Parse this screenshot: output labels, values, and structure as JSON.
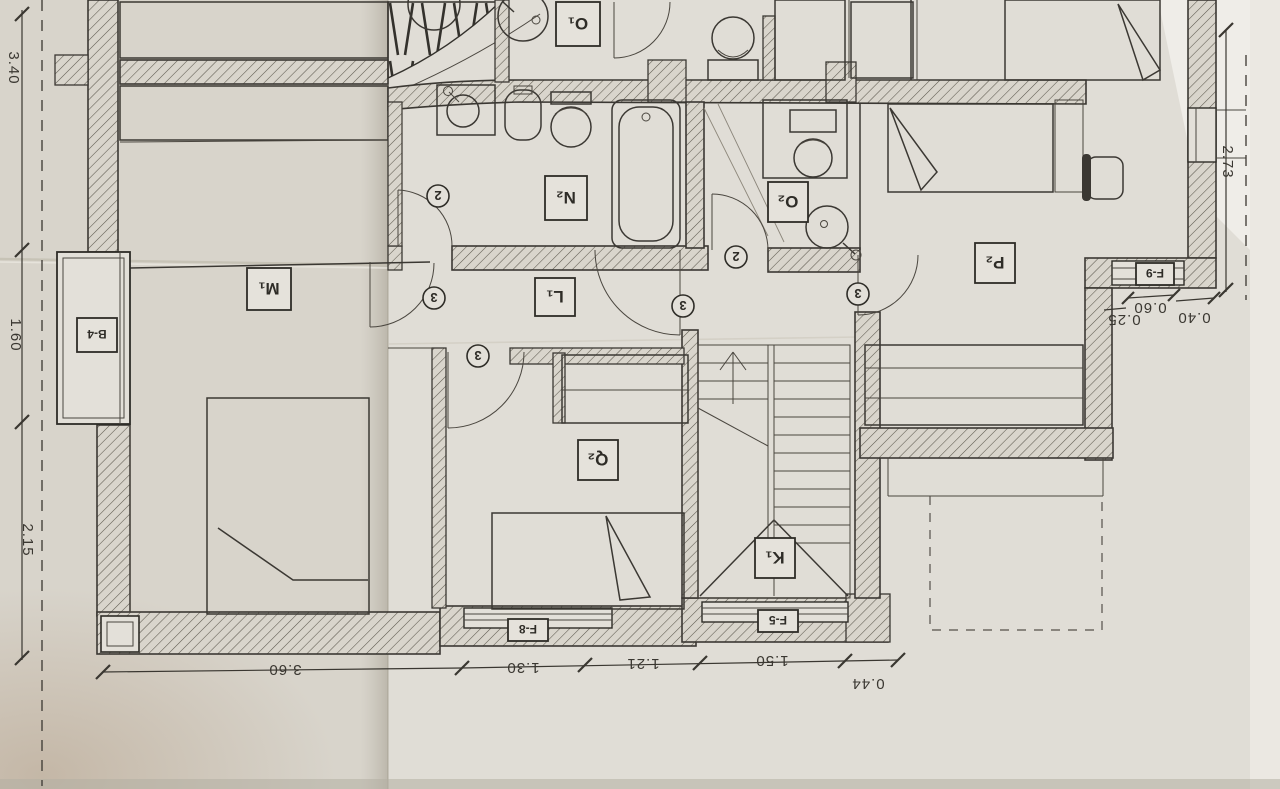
{
  "plan": {
    "rooms": [
      {
        "id": "M1",
        "label": "M₁"
      },
      {
        "id": "N2",
        "label": "N₂"
      },
      {
        "id": "O1",
        "label": "O₁"
      },
      {
        "id": "O2",
        "label": "O₂"
      },
      {
        "id": "P2",
        "label": "P₂"
      },
      {
        "id": "Q2",
        "label": "Q₂"
      },
      {
        "id": "L1",
        "label": "L₁"
      },
      {
        "id": "K1",
        "label": "K₁"
      }
    ],
    "openings": [
      {
        "id": "B4",
        "label": "B-4"
      },
      {
        "id": "F8",
        "label": "F-8"
      },
      {
        "id": "F5",
        "label": "F-5"
      },
      {
        "id": "F9",
        "label": "F-9"
      }
    ],
    "door_numbers": [
      {
        "value": "2"
      },
      {
        "value": "2"
      },
      {
        "value": "3"
      },
      {
        "value": "3"
      },
      {
        "value": "3"
      },
      {
        "value": "3"
      }
    ],
    "dimensions": {
      "left": [
        {
          "value": "3.40"
        },
        {
          "value": "1.60"
        },
        {
          "value": "2.15"
        }
      ],
      "bottom": [
        {
          "value": "3.60"
        },
        {
          "value": "1.30"
        },
        {
          "value": "1.21"
        },
        {
          "value": "1.50"
        },
        {
          "value": "0.44"
        }
      ],
      "right": [
        {
          "value": "2.73"
        }
      ],
      "corner": [
        {
          "value": "0.25"
        },
        {
          "value": "0.60"
        },
        {
          "value": "0.40"
        }
      ]
    },
    "colors": {
      "paper": "#d8d4cb",
      "paper_bright": "#e7e4de",
      "ink": "#3b3833"
    }
  }
}
